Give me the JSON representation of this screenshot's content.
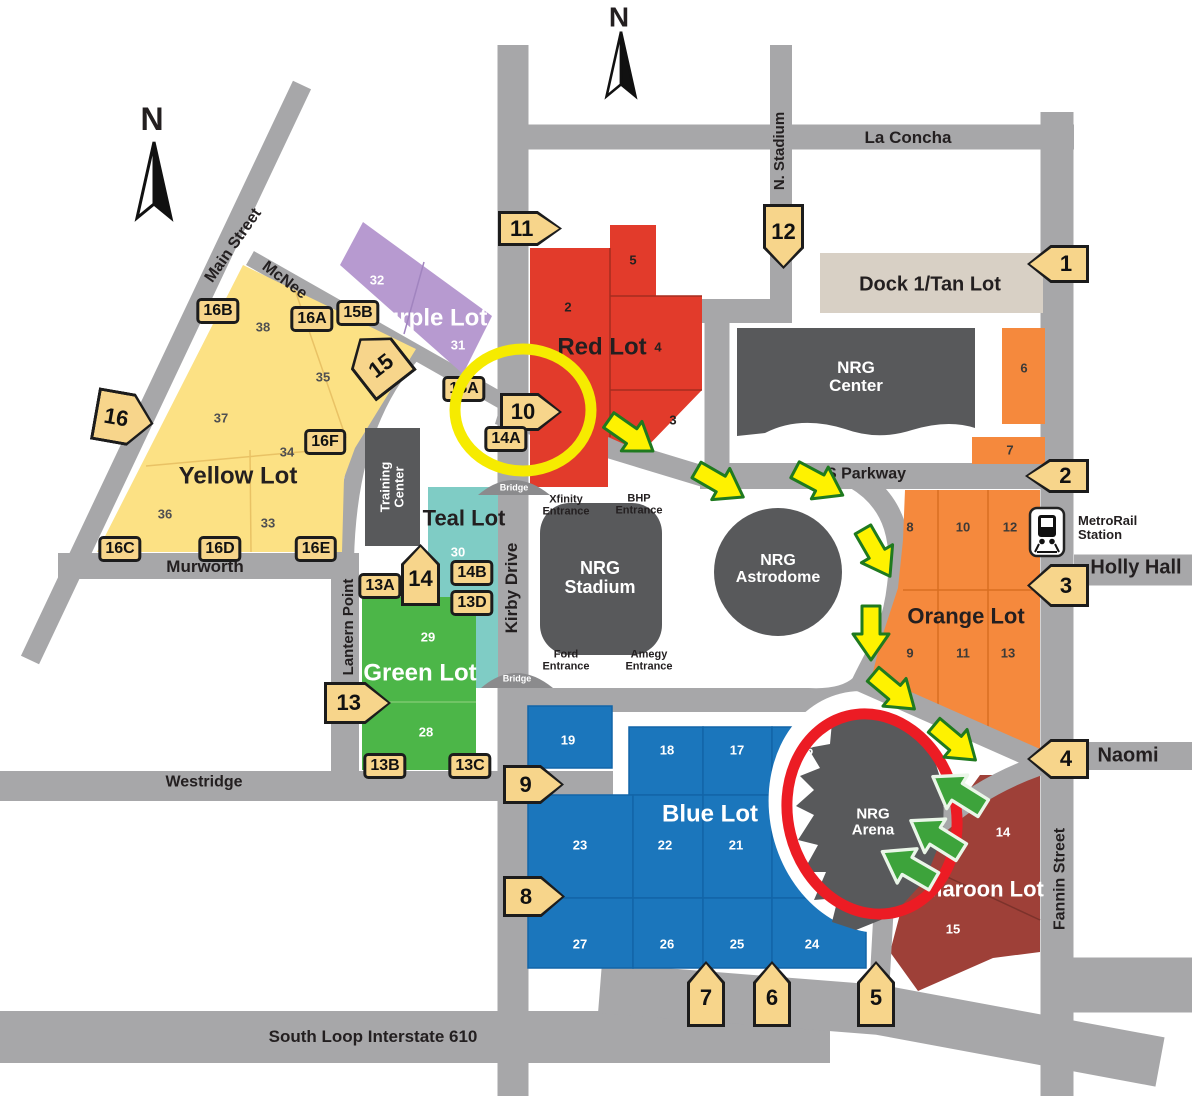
{
  "compass": {
    "north": "N"
  },
  "streets": {
    "main_street": "Main Street",
    "mcnee": "McNee",
    "murworth": "Murworth",
    "lantern_point": "Lantern Point",
    "westridge": "Westridge",
    "south_loop": "South Loop Interstate 610",
    "kirby_drive": "Kirby Drive",
    "n_stadium": "N. Stadium",
    "la_concha": "La Concha",
    "s_parkway": "S Parkway",
    "holly_hall": "Holly Hall",
    "naomi": "Naomi",
    "fannin_street": "Fannin Street"
  },
  "transit": {
    "metrorail_station": "MetroRail Station"
  },
  "bridges": [
    "Bridge",
    "Bridge"
  ],
  "buildings": {
    "nrg_center": "NRG Center",
    "nrg_stadium": "NRG Stadium",
    "nrg_astrodome": "NRG Astrodome",
    "nrg_arena": "NRG Arena",
    "training_center": "Training Center"
  },
  "entrances": [
    "Xfinity Entrance",
    "BHP Entrance",
    "Ford Entrance",
    "Amegy Entrance"
  ],
  "lots": {
    "yellow": {
      "name": "Yellow Lot",
      "color": "#fce184",
      "sections": [
        "38",
        "35",
        "37",
        "34",
        "36",
        "33"
      ]
    },
    "purple": {
      "name": "Purple Lot",
      "color": "#b79ad0",
      "sections": [
        "32",
        "31"
      ]
    },
    "red": {
      "name": "Red Lot",
      "color": "#e23b2b",
      "sections": [
        "5",
        "2",
        "4",
        "3"
      ]
    },
    "teal": {
      "name": "Teal Lot",
      "color": "#7fccc5",
      "sections": [
        "30"
      ]
    },
    "green": {
      "name": "Green Lot",
      "color": "#4cb648",
      "sections": [
        "29",
        "28"
      ]
    },
    "blue": {
      "name": "Blue Lot",
      "color": "#1b76bc",
      "sections": [
        "19",
        "18",
        "17",
        "16",
        "23",
        "22",
        "21",
        "20",
        "27",
        "26",
        "25",
        "24"
      ]
    },
    "orange": {
      "name": "Orange Lot",
      "color": "#f5893d",
      "sections": [
        "6",
        "7",
        "8",
        "10",
        "12",
        "9",
        "11",
        "13"
      ]
    },
    "maroon": {
      "name": "Maroon Lot",
      "color": "#9e4038",
      "sections": [
        "14",
        "15"
      ]
    },
    "tan": {
      "name": "Dock 1/Tan Lot",
      "color": "#d8d0c5"
    }
  },
  "gates": {
    "marker_color": "#f7d58b",
    "items": [
      "1",
      "2",
      "3",
      "4",
      "5",
      "6",
      "7",
      "8",
      "9",
      "10",
      "11",
      "12",
      "13",
      "14",
      "15",
      "16"
    ]
  },
  "sub_gates": [
    "16B",
    "16A",
    "15B",
    "16F",
    "16C",
    "16D",
    "16E",
    "15A",
    "14A",
    "14B",
    "13D",
    "13A",
    "13B",
    "13C"
  ],
  "highlights": {
    "yellow_circle_color": "#f6eb00",
    "red_circle_color": "#ec1c24",
    "route_arrow_color": "#fef200",
    "entry_arrow_color": "#3da33b",
    "road_color": "#a7a7a9",
    "building_color": "#58595b"
  }
}
